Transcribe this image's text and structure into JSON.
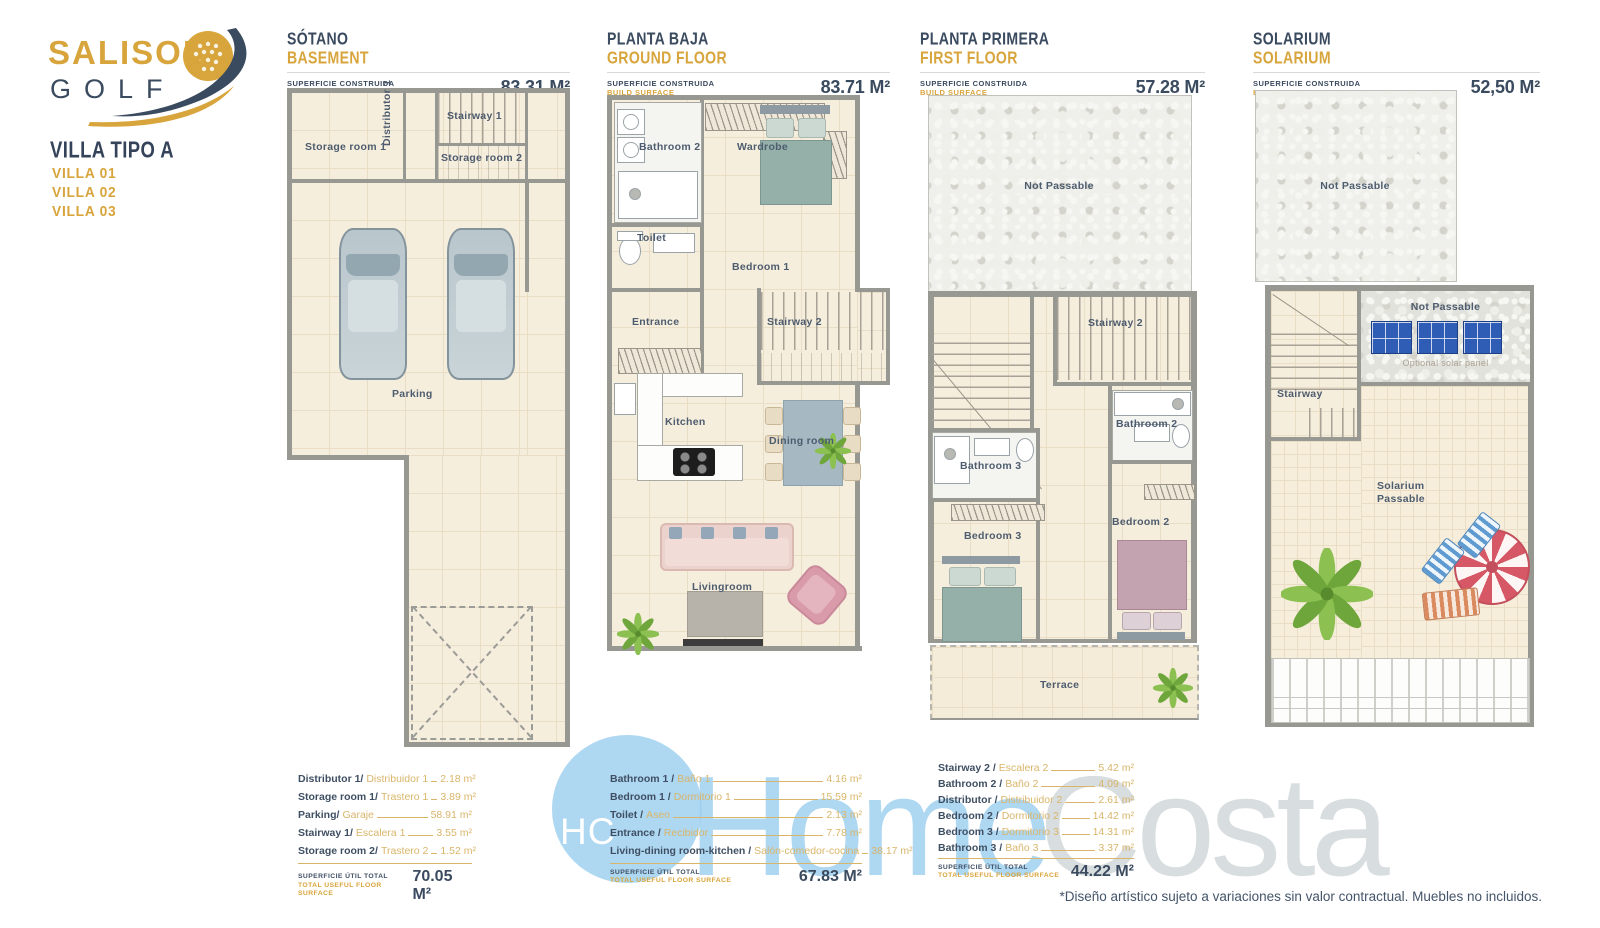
{
  "brand": {
    "salisol": "SALISOL",
    "golf": "GOLF",
    "villa_type": "VILLA TIPO A",
    "villas": [
      "VILLA 01",
      "VILLA 02",
      "VILLA 03"
    ]
  },
  "labels": {
    "surface_es": "SUPERFICIE CONSTRUIDA",
    "surface_en": "BUILD SURFACE",
    "total_es": "SUPERFICIE ÚTIL TOTAL",
    "total_en": "TOTAL USEFUL FLOOR SURFACE"
  },
  "floors": [
    {
      "title_es": "SÓTANO",
      "title_en": "BASEMENT",
      "surface": "83.31 M²",
      "rooms": {
        "storage1": "Storage room 1",
        "distributor": "Distributor 1",
        "stairway1": "Stairway 1",
        "storage2": "Storage room 2",
        "parking": "Parking"
      },
      "legend": [
        {
          "en": "Distributor 1/",
          "es": "Distribuidor 1",
          "value": "2.18 m²"
        },
        {
          "en": "Storage room 1/",
          "es": "Trastero 1",
          "value": "3.89 m²"
        },
        {
          "en": "Parking/",
          "es": "Garaje",
          "value": "58.91 m²"
        },
        {
          "en": "Stairway 1/",
          "es": "Escalera 1",
          "value": "3.55 m²"
        },
        {
          "en": "Storage room 2/",
          "es": "Trastero 2",
          "value": "1.52 m²"
        }
      ],
      "total": "70.05 M²"
    },
    {
      "title_es": "PLANTA BAJA",
      "title_en": "GROUND FLOOR",
      "surface": "83.71 M²",
      "rooms": {
        "bathroom2": "Bathroom 2",
        "wardrobe": "Wardrobe",
        "toilet": "Toilet",
        "bedroom1": "Bedroom 1",
        "entrance": "Entrance",
        "stairway2": "Stairway 2",
        "kitchen": "Kitchen",
        "dining": "Dining room",
        "living": "Livingroom"
      },
      "legend": [
        {
          "en": "Bathroom 1 /",
          "es": "Baño 1",
          "value": "4.16 m²"
        },
        {
          "en": "Bedroom 1 /",
          "es": "Dormitorio 1",
          "value": "15.59 m²"
        },
        {
          "en": "Toilet /",
          "es": "Aseo",
          "value": "2.13 m²"
        },
        {
          "en": "Entrance /",
          "es": "Recibidor",
          "value": "7.78 m²"
        },
        {
          "en": "Living-dining room-kitchen /",
          "es": "Salón-comedor-cocina",
          "value": "38.17 m²"
        }
      ],
      "total": "67.83 M²"
    },
    {
      "title_es": "PLANTA PRIMERA",
      "title_en": "FIRST FLOOR",
      "surface": "57.28 M²",
      "rooms": {
        "not_passable": "Not Passable",
        "stairway2": "Stairway 2",
        "bathroom3": "Bathroom 3",
        "bathroom2": "Bathroom 2",
        "bedroom3": "Bedroom 3",
        "bedroom2": "Bedroom 2",
        "terrace": "Terrace"
      },
      "legend": [
        {
          "en": "Stairway 2 /",
          "es": "Escalera 2",
          "value": "5.42 m²"
        },
        {
          "en": "Bathroom 2 /",
          "es": "Baño 2",
          "value": "4.09 m²"
        },
        {
          "en": "Distributor /",
          "es": "Distribuidor 2",
          "value": "2.61 m²"
        },
        {
          "en": "Bedroom 2 /",
          "es": "Dormitorio 2",
          "value": "14.42 m²"
        },
        {
          "en": "Bedroom 3 /",
          "es": "Dormitorio 3",
          "value": "14.31 m²"
        },
        {
          "en": "Bathroom 3 /",
          "es": "Baño 3",
          "value": "3.37 m²"
        }
      ],
      "total": "44.22 M²"
    },
    {
      "title_es": "SOLARIUM",
      "title_en": "SOLARIUM",
      "surface": "52,50 M²",
      "rooms": {
        "not_passable_top": "Not Passable",
        "not_passable_panels": "Not Passable",
        "optional_panel": "Optional solar panel",
        "stairway": "Stairway",
        "solarium_1": "Solarium",
        "solarium_2": "Passable"
      }
    }
  ],
  "watermark": {
    "monogram": "HC",
    "home": "Home",
    "costa": "Costa"
  },
  "disclaimer": "*Diseño artístico sujeto a variaciones sin valor contractual. Muebles no incluidos.",
  "colors": {
    "gold": "#d8a53c",
    "navy": "#3a4a5f",
    "floor_beige": "#f6eedd",
    "wall_gray": "#989893",
    "watermark_blue": "#a0d0ee",
    "watermark_gray": "#ced4d7"
  }
}
